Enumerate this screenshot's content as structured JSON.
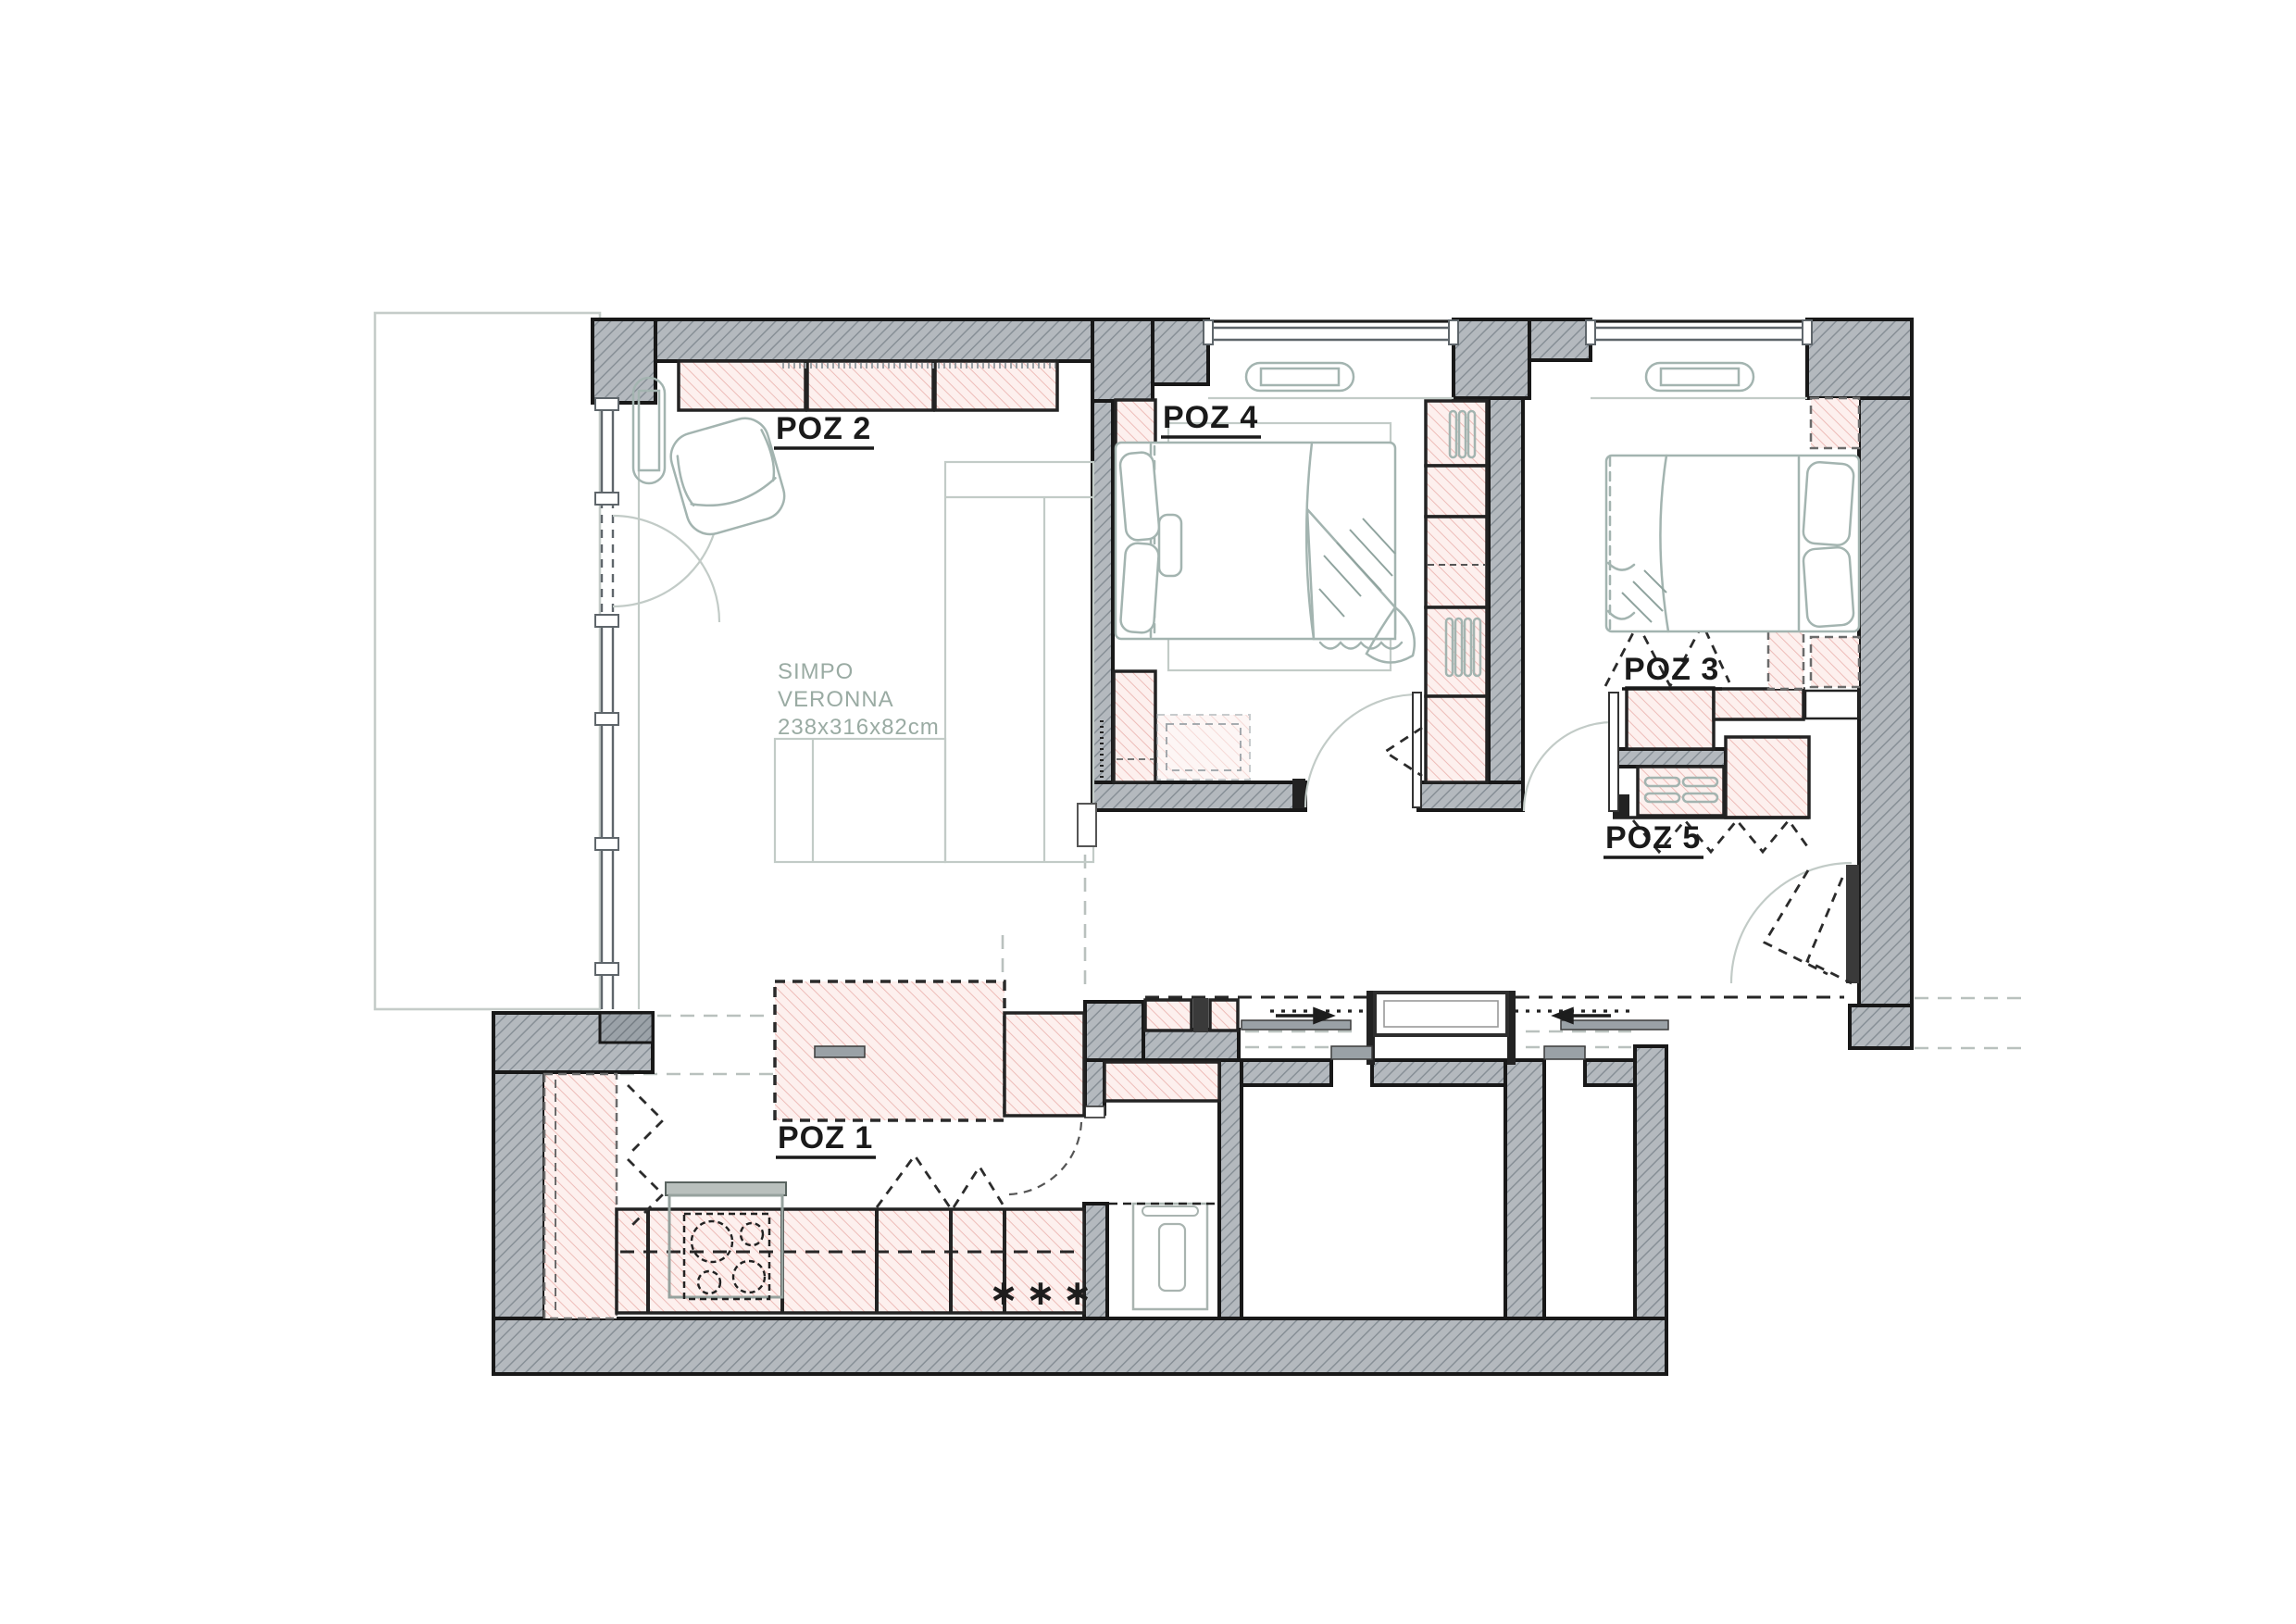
{
  "document": {
    "type": "apartment floor plan drawing",
    "orientation": "landscape"
  },
  "labels": {
    "poz1": "POZ 1",
    "poz2": "POZ 2",
    "poz3": "POZ 3",
    "poz4": "POZ 4",
    "poz5": "POZ 5"
  },
  "note": {
    "line1": "SIMPO",
    "line2": "VERONNA",
    "line3": "238x316x82cm"
  },
  "symbols": {
    "appliance_marker": "∗∗∗"
  },
  "colors": {
    "floor": "#ffffff",
    "wall_fill": "#b4b9be",
    "wall_hatch": "#878f96",
    "wall_dark_fill": "#9ba2a8",
    "furniture_fill": "#fdf0ee",
    "furniture_hatch": "#edbcb8",
    "outline": "#181818",
    "sketch_gray": "#a3b4b0",
    "terrace_outline": "#c5ccc9",
    "label_text": "#1a1a1a",
    "note_text": "#9aaba3"
  }
}
